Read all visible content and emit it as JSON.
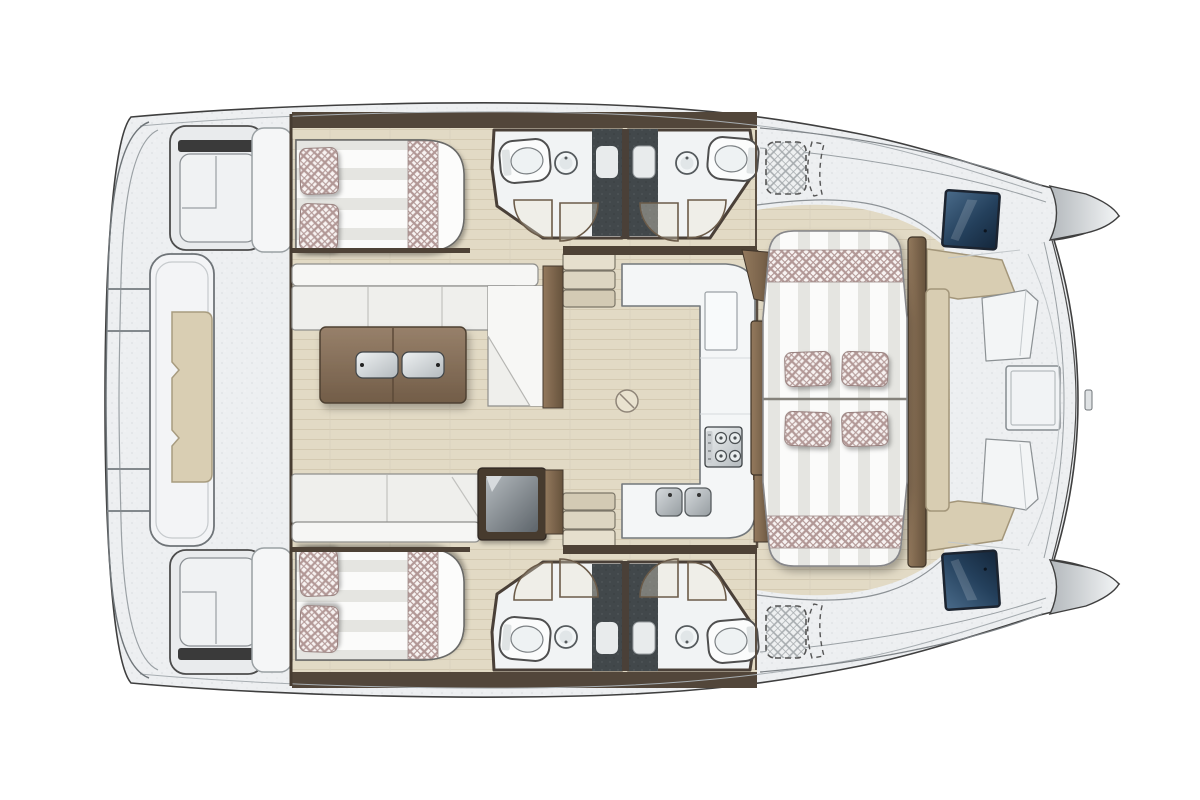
{
  "diagram": {
    "title": "Catamaran yacht deck layout plan, top-down view",
    "orientation": {
      "left_side": "stern with swim platform and davits",
      "right_side": "bow"
    },
    "hulls": {
      "top": "port hull",
      "bottom": "starboard hull"
    }
  },
  "palette": {
    "background": "#ffffff",
    "deck_gray": "#edeff1",
    "outline": "#3f3f3f",
    "floor_wood": "#e2dac5",
    "wall_dark_wood": "#4e4236",
    "furniture_wood": "#7d6853",
    "upholstery_white": "#f4f4f1",
    "checker_accent": "#b29896",
    "cushion_beige": "#d8cdb2",
    "shower_dark": "#42484b",
    "window_navy": "#1c2f45",
    "metal": "#c9ced1"
  },
  "areas": {
    "stern_platform": {
      "name": "Aft platform with dinghy davit pad",
      "pads": 1
    },
    "transom_steps": {
      "name": "Transom boarding steps",
      "count": 2
    },
    "port_cabin": {
      "name": "Aft double cabin (port)",
      "pillows": 2,
      "beds": 1
    },
    "starboard_cabin": {
      "name": "Aft double cabin (starboard)",
      "pillows": 2,
      "beds": 1
    },
    "bathrooms": {
      "name": "En-suite bathrooms with shower",
      "count": 4,
      "toilets": 4,
      "sinks": 4,
      "showers": 4
    },
    "saloon": {
      "name": "Saloon with L-sofa and coffee table",
      "sofas": 2,
      "coffee_table_trays": 2,
      "fridge": 1
    },
    "galley": {
      "name": "U-shaped galley",
      "stove_burners": 4,
      "sinks": 2
    },
    "companionways": {
      "name": "Companionway steps to hulls",
      "count": 2,
      "steps_each": 3
    },
    "forward_cockpit": {
      "name": "Forward cockpit lounge",
      "sunpad_sections": 2,
      "pillows": 4,
      "side_tables": 3
    },
    "foredeck": {
      "name": "Foredeck with U-bench and hatch",
      "bench_cushions": 3,
      "deck_hatch": 1,
      "hull_windows": 2,
      "bow_cones": 2
    },
    "options": {
      "name": "Optional equipment areas (dashed)",
      "count": 2
    }
  }
}
